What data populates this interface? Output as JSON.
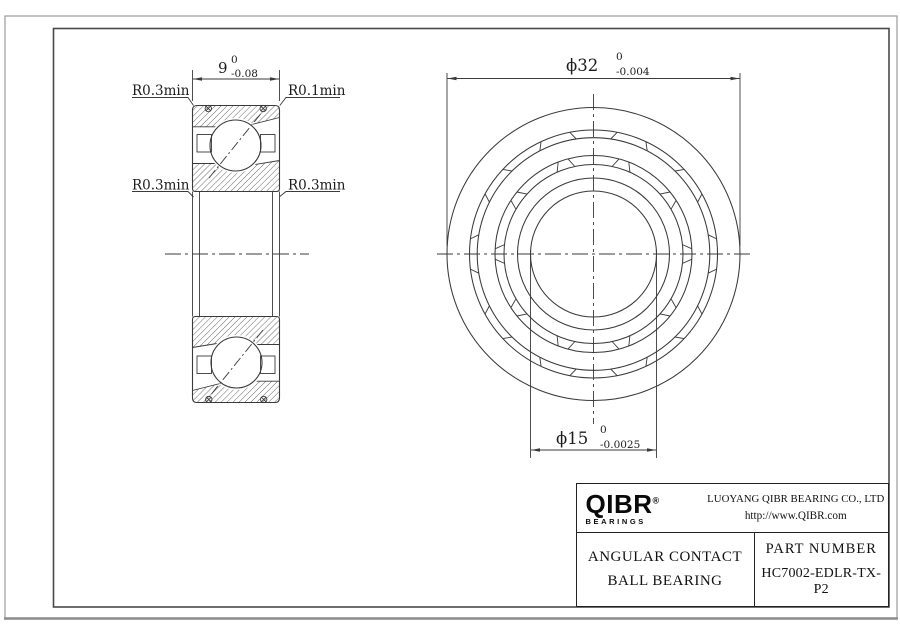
{
  "drawing": {
    "section_view": {
      "width_dim": {
        "value": "9",
        "tol_upper": "0",
        "tol_lower": "-0.08"
      },
      "labels": {
        "top_left": "R0.3min",
        "top_right": "R0.1min",
        "mid_left": "R0.3min",
        "mid_right": "R0.3min"
      }
    },
    "front_view": {
      "od_dim": {
        "value": "ϕ32",
        "tol_upper": "0",
        "tol_lower": "-0.004"
      },
      "bore_dim": {
        "value": "ϕ15",
        "tol_upper": "0",
        "tol_lower": "-0.0025"
      }
    }
  },
  "title_block": {
    "logo": {
      "text": "QIBR",
      "registered": "®",
      "subtext": "BEARINGS"
    },
    "company": "LUOYANG QIBR BEARING CO., LTD",
    "website": "http://www.QIBR.com",
    "product_type_line1": "ANGULAR CONTACT",
    "product_type_line2": "BALL BEARING",
    "part_number_label": "PART NUMBER",
    "part_number": "HC7002-EDLR-TX-P2"
  },
  "colors": {
    "line": "#3a3a3a",
    "frame": "#4a4a4a",
    "outer_border": "#999999",
    "background": "#ffffff"
  }
}
